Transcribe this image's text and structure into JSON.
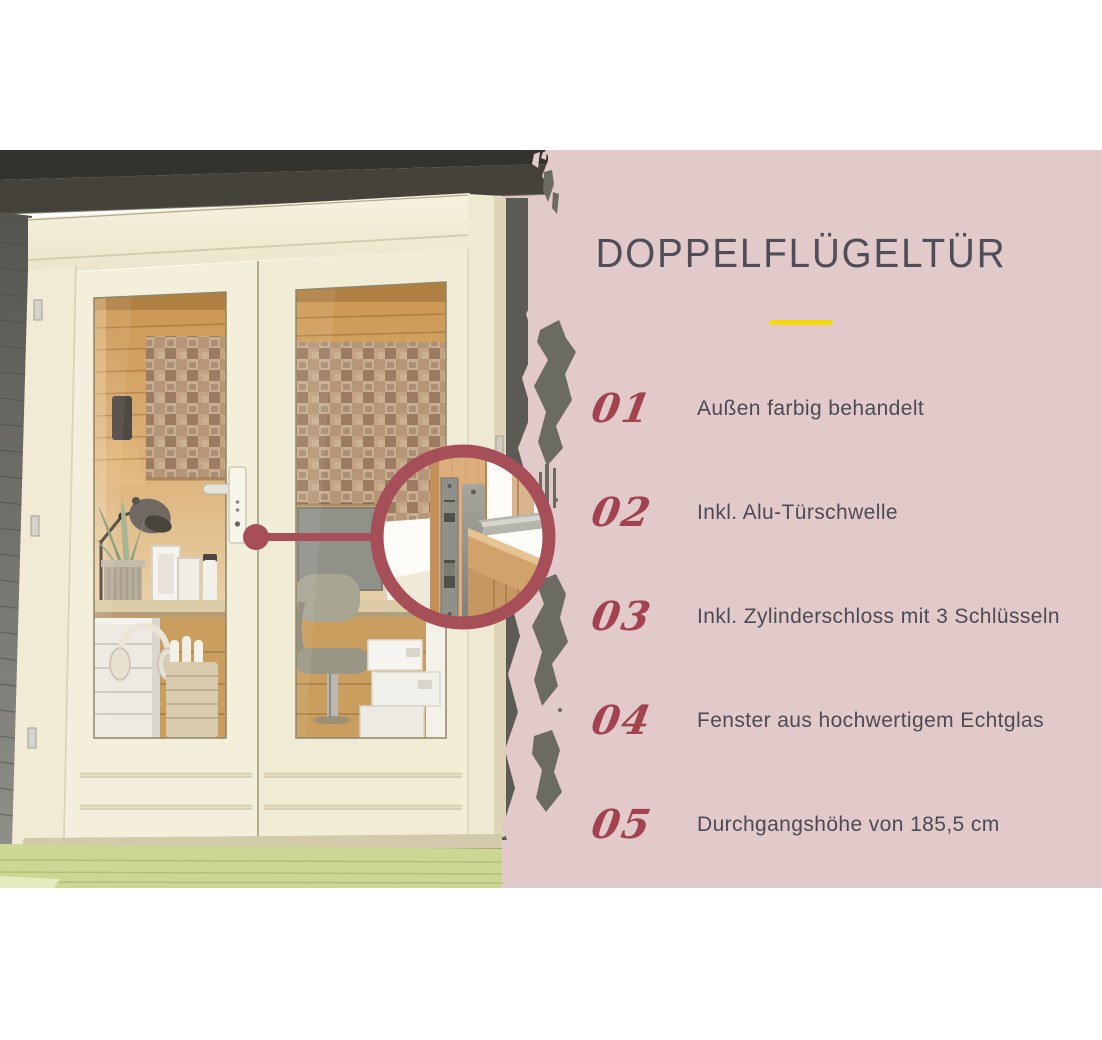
{
  "panel": {
    "title": "DOPPELFLÜGELTÜR",
    "features": [
      {
        "num": "01",
        "text": "Außen farbig behandelt"
      },
      {
        "num": "02",
        "text": "Inkl. Alu-Türschwelle"
      },
      {
        "num": "03",
        "text": "Inkl. Zylinderschloss mit 3 Schlüsseln"
      },
      {
        "num": "04",
        "text": "Fenster aus hochwertigem Echtglas"
      },
      {
        "num": "05",
        "text": "Durchgangshöhe von 185,5 cm"
      }
    ],
    "colors": {
      "panel_background": "#e3caca",
      "title_text": "#4f4d58",
      "number_text": "#a2434f",
      "feature_text": "#4b4b55",
      "divider_yellow": "#f6d908",
      "magnifier_ring": "#a74f58",
      "grunge_gray": "#6c6b63"
    }
  },
  "photo": {
    "subject": "garden-house-double-door-with-office-interior",
    "magnifier_detail": "door-lock-with-lever-handle"
  }
}
